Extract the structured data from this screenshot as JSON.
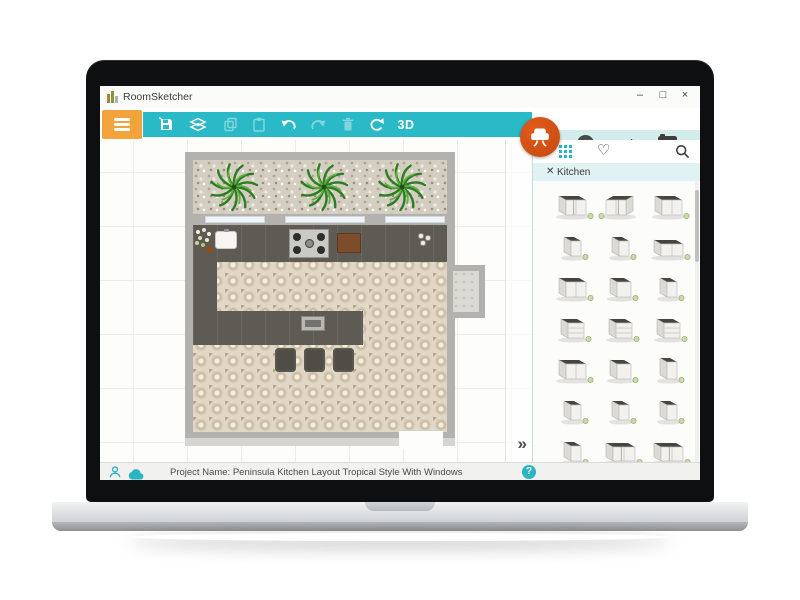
{
  "window": {
    "title": "RoomSketcher",
    "minimize": "–",
    "maximize": "□",
    "close": "×"
  },
  "toolbar": {
    "mode_3d": "3D",
    "tools": [
      {
        "name": "save",
        "enabled": true
      },
      {
        "name": "floors",
        "enabled": true
      },
      {
        "name": "copy",
        "enabled": false
      },
      {
        "name": "paste",
        "enabled": false
      },
      {
        "name": "undo",
        "enabled": true
      },
      {
        "name": "redo",
        "enabled": false
      },
      {
        "name": "delete",
        "enabled": false
      },
      {
        "name": "rotate",
        "enabled": true
      },
      {
        "name": "view-3d",
        "enabled": true
      }
    ]
  },
  "panel": {
    "tabs": [
      {
        "name": "add-items",
        "icon": "plus-circle-icon",
        "active": true
      },
      {
        "name": "draw",
        "icon": "pencil-icon",
        "active": false
      },
      {
        "name": "snapshot",
        "icon": "camera-icon",
        "active": false
      }
    ],
    "view_icons": [
      "grid-view-icon",
      "favorites-heart-icon",
      "search-icon"
    ],
    "filter_close": "✕",
    "filter_label": "Kitchen",
    "items": [
      "corner-left",
      "corner-front",
      "wide",
      "narrow",
      "narrow",
      "wide-low",
      "wide",
      "medium",
      "narrow",
      "drawers",
      "drawers",
      "drawers",
      "wide",
      "medium",
      "narrow-tall",
      "narrow",
      "narrow",
      "narrow",
      "narrow",
      "corner-wide",
      "corner-wide",
      "wide",
      "wide",
      "wide"
    ]
  },
  "canvas": {
    "expand": "»",
    "floorplan_elements": [
      "gravel-bed",
      "palm-plants",
      "windows",
      "kitchen-sink",
      "flower-pot",
      "cooktop",
      "cutting-board",
      "spice-jars",
      "peninsula-counter",
      "peninsula-sink",
      "bar-stools",
      "door-mat"
    ]
  },
  "statusbar": {
    "project": "Project Name: Peninsula Kitchen Layout Tropical Style With Windows",
    "help": "?"
  },
  "colors": {
    "teal": "#29b9c7",
    "tab_strip": "#d3ecec",
    "menu_orange": "#f2a33c",
    "fab_orange": "#c64a10",
    "tab_underline": "#efa94a",
    "wall": "#b3b2ae",
    "counter": "#5e5b54",
    "floor": "#e2d8c7"
  }
}
